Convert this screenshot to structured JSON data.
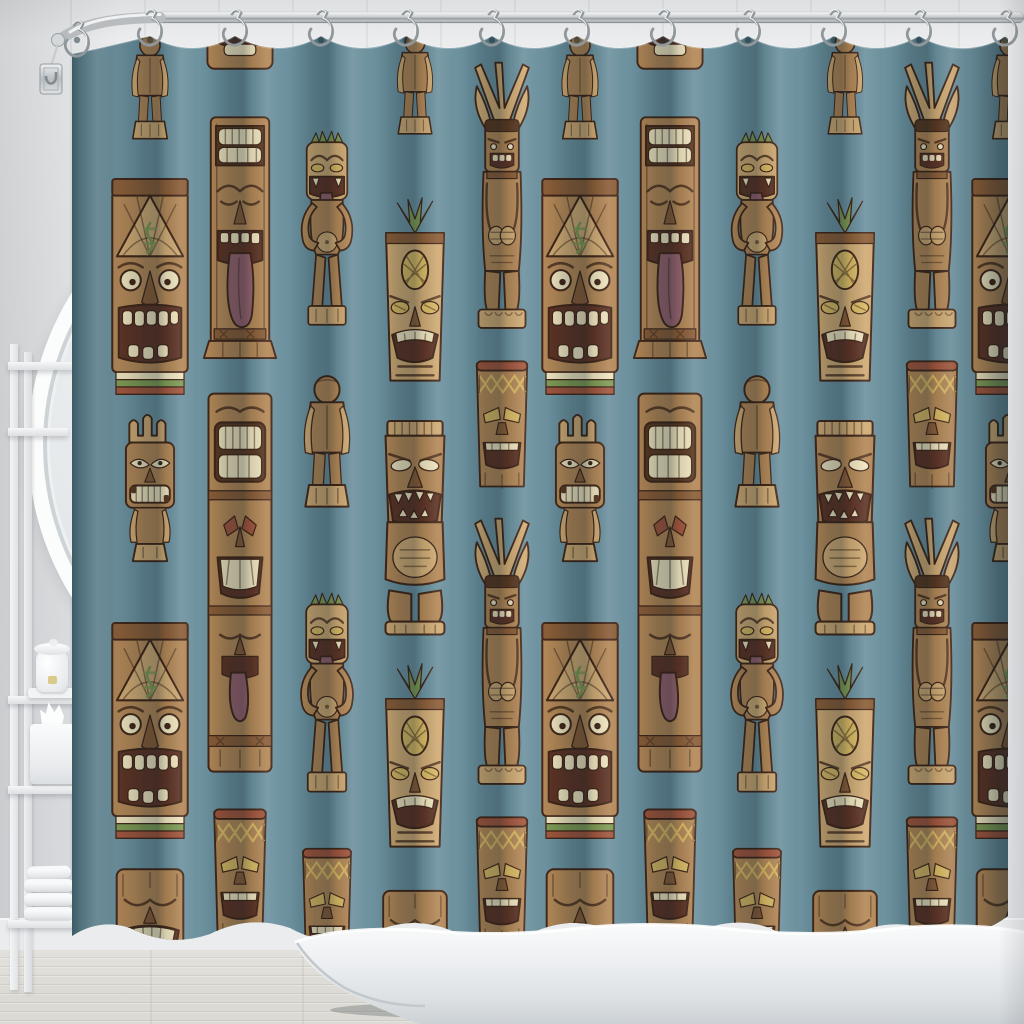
{
  "scene": {
    "setting": "bathroom product photo",
    "subject": "shower curtain with carved tiki totem pattern",
    "no_visible_text": true,
    "objects": [
      "shower-curtain",
      "curtain-rod",
      "shower-hooks",
      "round-mirror",
      "ladder-shelf",
      "ceramic-jar",
      "tissue-box",
      "towel-stack",
      "freestanding-bathtub",
      "shiplap-wall",
      "wood-plank-floor"
    ]
  },
  "colors": {
    "wall": "#e6e7e9",
    "baseboard": "#eaecee",
    "floor": "#dcdad4",
    "curtain": "#6b909d",
    "curtainDark": "#59808e",
    "curtainLight": "#7b9dab",
    "outline": "#402516",
    "woodLight": "#cfa972",
    "woodMid": "#b28655",
    "woodDark": "#8a5c36",
    "woodDeep": "#59371f",
    "cream": "#efe3bd",
    "maroon": "#5d3223",
    "tongue": "#95616b",
    "green": "#7f9a53",
    "yellow": "#d8b862",
    "rust": "#a1543b",
    "chrome": "#c3c7ca",
    "tub": "#f2f4f5"
  },
  "rod": {
    "material": "chrome",
    "hook_count": 12,
    "hooks": [
      {
        "x": 77,
        "y": 26
      },
      {
        "x": 150,
        "y": 15
      },
      {
        "x": 235,
        "y": 15
      },
      {
        "x": 321,
        "y": 15
      },
      {
        "x": 406,
        "y": 15
      },
      {
        "x": 492,
        "y": 15
      },
      {
        "x": 577,
        "y": 15
      },
      {
        "x": 663,
        "y": 15
      },
      {
        "x": 748,
        "y": 15
      },
      {
        "x": 834,
        "y": 15
      },
      {
        "x": 919,
        "y": 15
      },
      {
        "x": 1005,
        "y": 15
      }
    ]
  },
  "curtain": {
    "fabric_color": "#6b909d",
    "motif_names": [
      "lizard-mask",
      "tongue-totem",
      "monkey-tiki",
      "pineapple-tiki",
      "warrior-totem",
      "tiki-drum",
      "back-figure",
      "stacked-totem",
      "statue-tiki",
      "sleepy-mask",
      "crowned-tiki"
    ],
    "tile_offsets": [
      0,
      430,
      860
    ],
    "columns_per_offset": [
      5,
      5,
      1
    ],
    "columns": [
      {
        "cx": 150,
        "items": [
          [
            "back",
            28,
            72,
            115
          ],
          [
            "lizard",
            168,
            92,
            230
          ],
          [
            "crown",
            408,
            86,
            155
          ],
          [
            "lizard",
            612,
            92,
            230
          ],
          [
            "sleepy",
            862,
            90,
            135
          ]
        ]
      },
      {
        "cx": 240,
        "items": [
          [
            "sleepy",
            -58,
            88,
            132
          ],
          [
            "tongue",
            112,
            86,
            254
          ],
          [
            "stack",
            390,
            90,
            387
          ],
          [
            "drum",
            800,
            86,
            146
          ]
        ]
      },
      {
        "cx": 327,
        "items": [
          [
            "monkey",
            128,
            78,
            211
          ],
          [
            "back",
            368,
            90,
            144
          ],
          [
            "monkey",
            590,
            80,
            216
          ],
          [
            "drum",
            840,
            80,
            136
          ]
        ]
      },
      {
        "cx": 415,
        "items": [
          [
            "back",
            26,
            70,
            112
          ],
          [
            "pine",
            196,
            88,
            189
          ],
          [
            "statue",
            410,
            92,
            230
          ],
          [
            "pine",
            662,
            88,
            189
          ],
          [
            "sleepy",
            884,
            86,
            129
          ]
        ]
      },
      {
        "cx": 502,
        "items": [
          [
            "warrior",
            56,
            84,
            277
          ],
          [
            "drum",
            352,
            84,
            143
          ],
          [
            "warrior",
            512,
            84,
            277
          ],
          [
            "drum",
            808,
            84,
            143
          ]
        ]
      }
    ]
  },
  "shelf": {
    "items": [
      "ceramic jar with lid",
      "tissue box",
      "folded white towels"
    ],
    "towel_count": 4
  }
}
